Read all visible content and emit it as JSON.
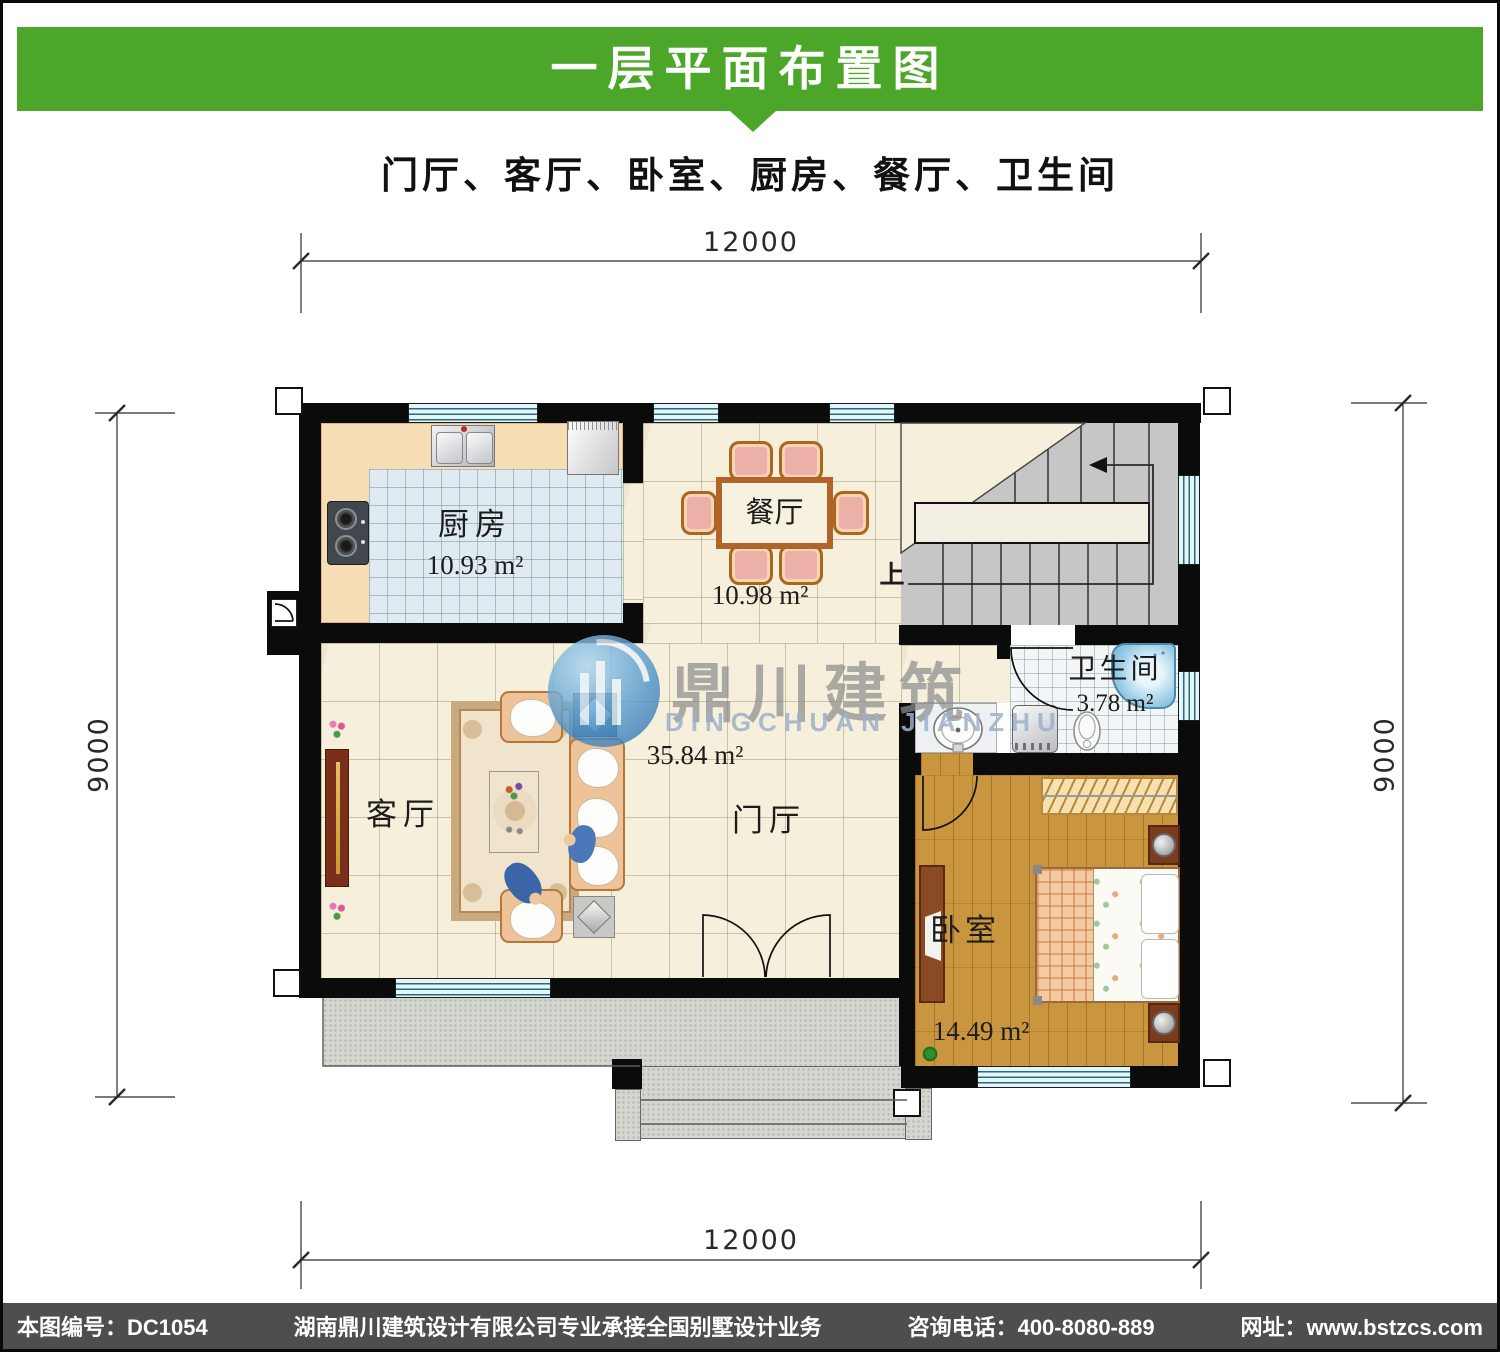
{
  "header": {
    "title": "一层平面布置图",
    "subtitle": "门厅、客厅、卧室、厨房、餐厅、卫生间",
    "accent_color": "#4ca629"
  },
  "plan": {
    "dimensions": {
      "top": "12000",
      "bottom": "12000",
      "left": "9000",
      "right": "9000"
    },
    "rooms": {
      "kitchen": {
        "name": "厨房",
        "area": "10.93 m²"
      },
      "dining": {
        "name": "餐厅",
        "area": "10.98 m²"
      },
      "bathroom": {
        "name": "卫生间",
        "area": "3.78 m²"
      },
      "living": {
        "name": "客厅"
      },
      "foyer": {
        "name": "门厅",
        "area": "35.84 m²"
      },
      "bedroom": {
        "name": "卧室",
        "area": "14.49 m²"
      }
    },
    "stairs": {
      "up_label": "上"
    }
  },
  "watermark": {
    "cn": "鼎川建筑",
    "en": "DINGCHUAN JIANZHU"
  },
  "footer": {
    "drawing_no": "本图编号：DC1054",
    "company": "湖南鼎川建筑设计有限公司专业承接全国别墅设计业务",
    "phone": "咨询电话：400-8080-889",
    "website": "网址：www.bstzcs.com"
  }
}
